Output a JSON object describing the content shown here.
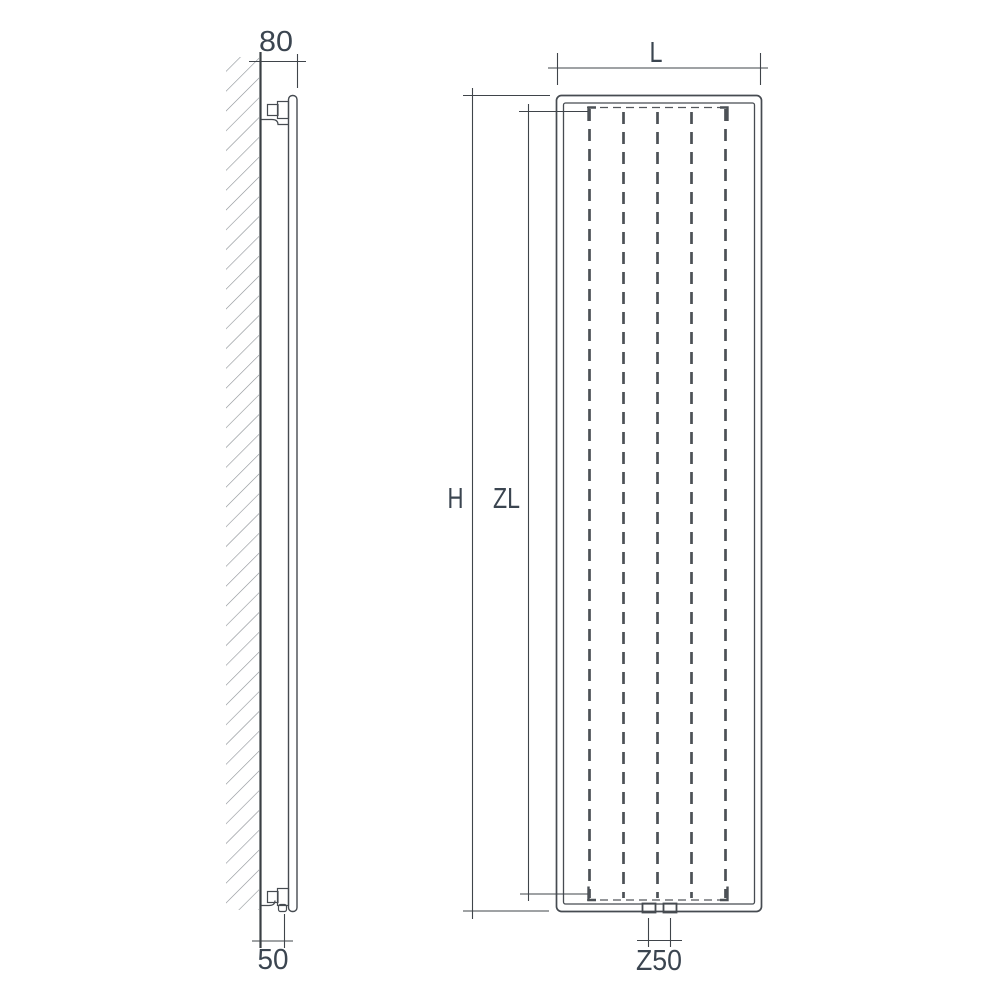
{
  "diagram": {
    "title": "Vertical radiator dimension drawing (side view and front view)",
    "side_view": {
      "depth_dim_label": "80",
      "bottom_offset_dim_label": "50"
    },
    "front_view": {
      "width_dim_label": "L",
      "height_dim_label": "H",
      "inner_height_dim_label": "ZL",
      "connection_dim_label": "Z50",
      "fin_lines_count": 5,
      "connection_stubs_count": 2
    },
    "colors": {
      "background": "#ffffff",
      "drawing_lines": "#464b51",
      "dimension_lines": "#3f444a",
      "dashed_fins": "#4c5156",
      "hatch": "#8a8f94",
      "label_text": "#3b4550"
    }
  }
}
